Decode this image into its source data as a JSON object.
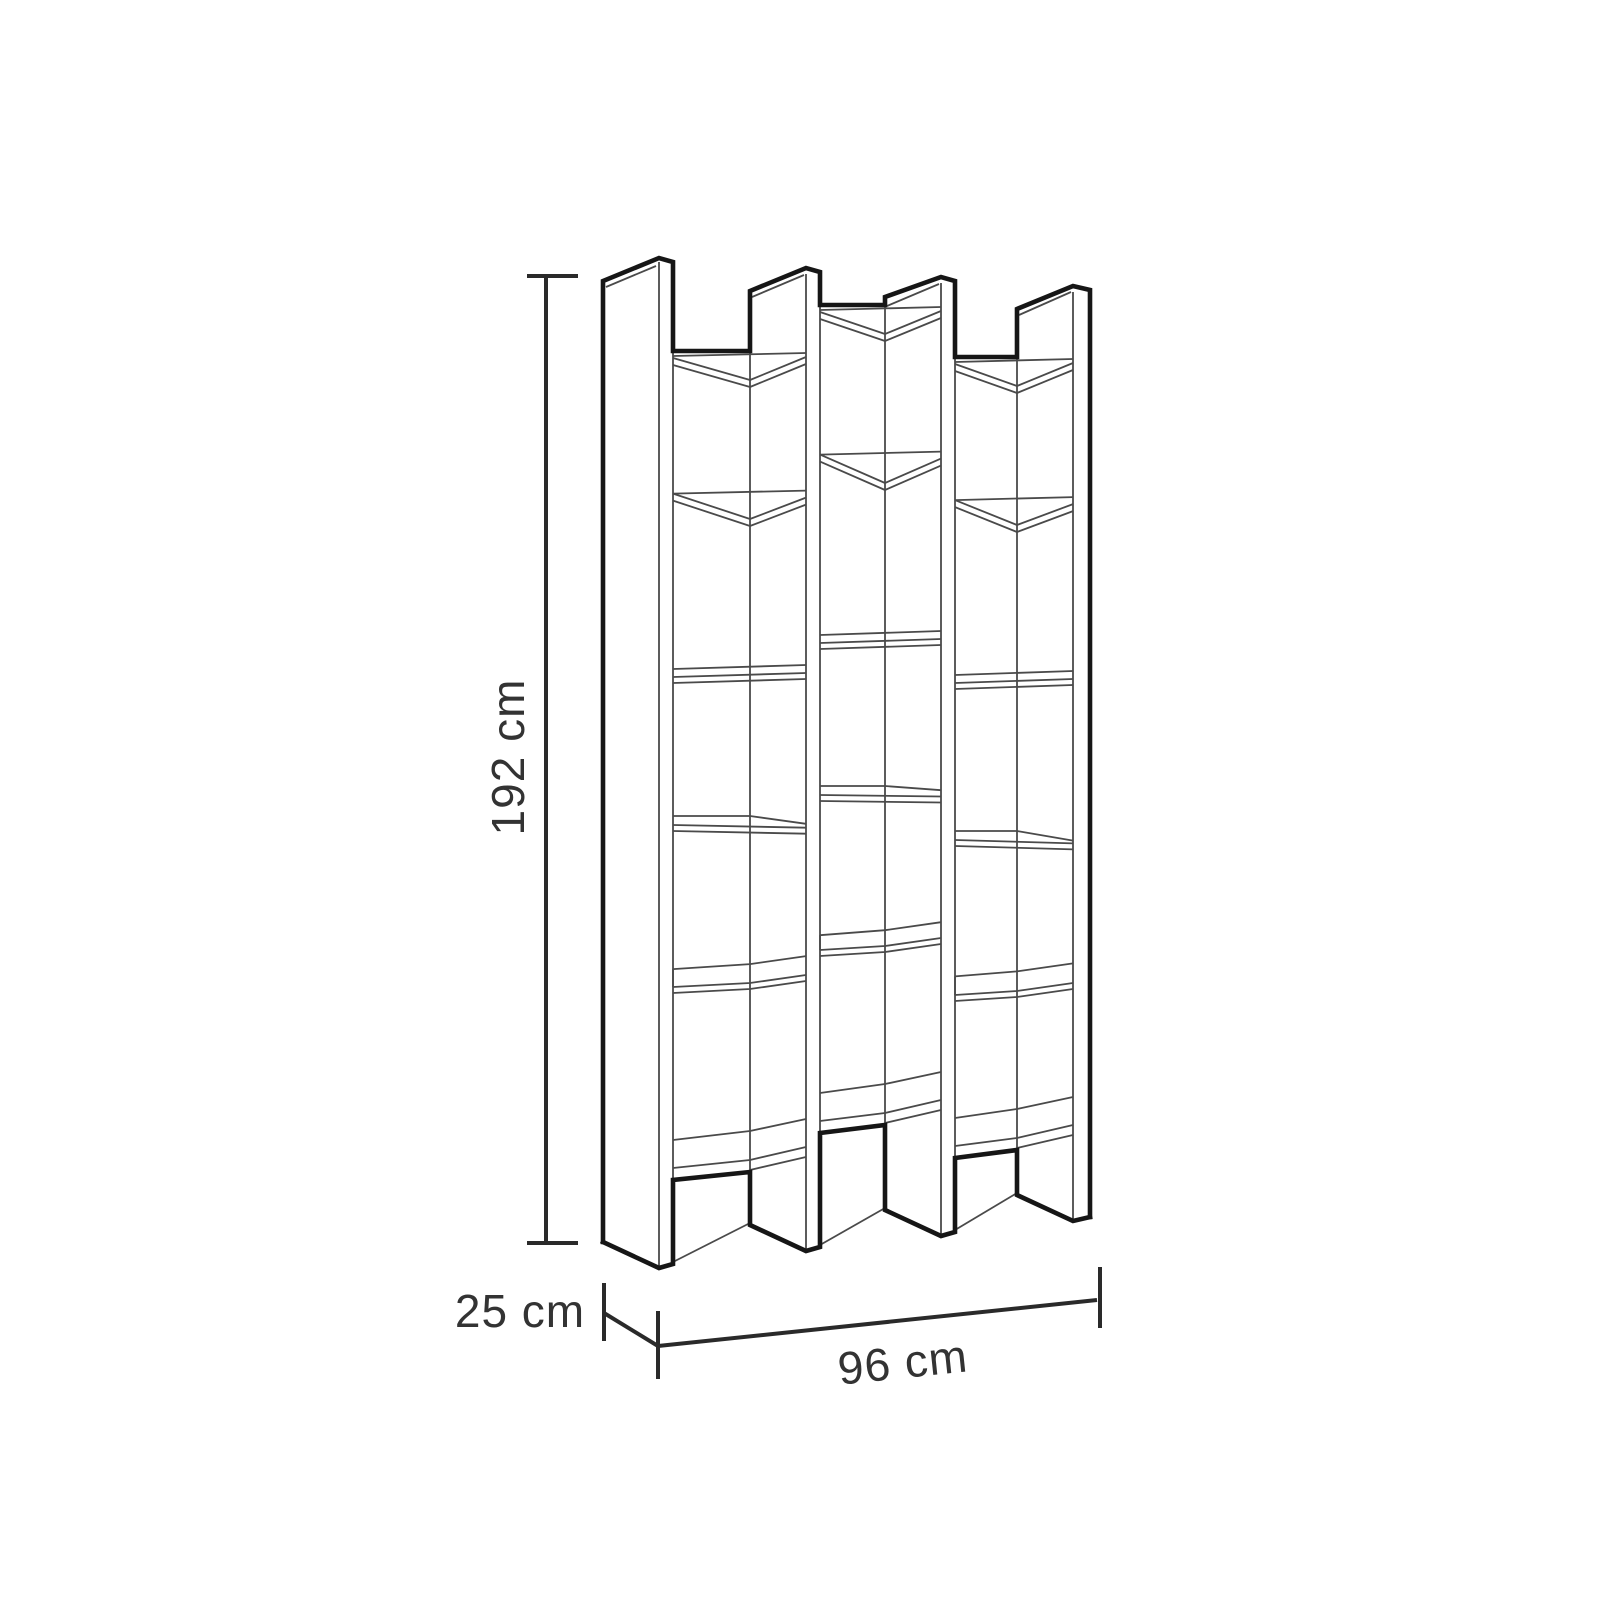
{
  "diagram": {
    "type": "furniture-dimension-drawing",
    "subject": "staggered cube bookcase, isometric line drawing",
    "labels": {
      "height": "192 cm",
      "depth": "25 cm",
      "width": "96 cm"
    },
    "structure": {
      "vertical_panels": 4,
      "columns": 3,
      "shelves_per_column": 6,
      "open_cubbies_per_column": 5,
      "staggered_top": true,
      "foot_arches": 3
    },
    "colors": {
      "background": "#ffffff",
      "outline": "#161616",
      "interior_line": "#4a4a4a",
      "dimension_line": "#2a2a2a",
      "text": "#333333"
    }
  }
}
